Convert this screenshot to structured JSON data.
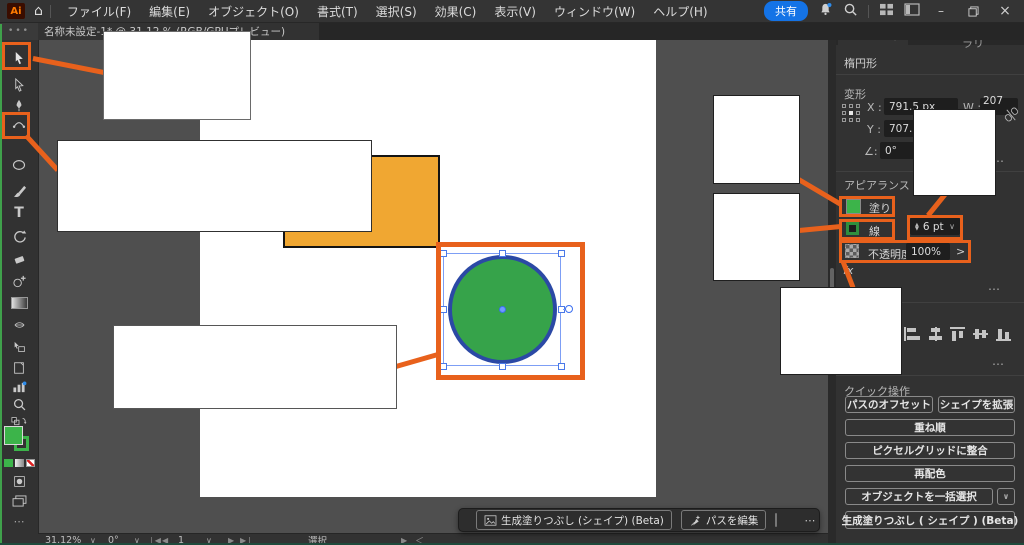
{
  "colors": {
    "annotation_orange": "#E8611C",
    "fill_green": "#3CB44A",
    "shape_orange": "#F0A732",
    "circle_stroke_blue": "#2B49A5",
    "share_blue": "#1473E6",
    "panel_bg": "#323232"
  },
  "icons": {
    "more": "⋯",
    "chevron_down": "∨",
    "chevron_right": ">",
    "home": "⌂",
    "type_tool": "T",
    "double_chevron": "≡",
    "minimize": "–",
    "close": "×",
    "prev": "◀",
    "next": "▶",
    "left_angle": "＜",
    "up": "▲",
    "down": "▼"
  },
  "title_bar": {
    "logo": "Ai",
    "menus": [
      "ファイル(F)",
      "編集(E)",
      "オブジェクト(O)",
      "書式(T)",
      "選択(S)",
      "効果(C)",
      "表示(V)",
      "ウィンドウ(W)",
      "ヘルプ(H)"
    ],
    "share_label": "共有"
  },
  "document_tab": {
    "title": "名称未設定-1* @ 31.12 % (RGB/GPUプレビュー)"
  },
  "canvas": {
    "artboard_color": "#FFFFFF",
    "shapes": [
      {
        "type": "rectangle",
        "fill": "#F0A732",
        "stroke": "#111111"
      },
      {
        "type": "ellipse",
        "fill": "#36A34A",
        "stroke": "#2B49A5",
        "selected": true
      }
    ]
  },
  "panel": {
    "tabs": [
      "プロパティ",
      "レイヤー",
      "CC ライブラリ"
    ],
    "object_type": "楕円形",
    "transform": {
      "label": "変形",
      "x_label": "X :",
      "x_value": "791.5 px",
      "y_label": "Y :",
      "y_value": "707.5",
      "w_label": "W :",
      "w_value": "207 px",
      "angle_label": "∠:",
      "angle_value": "0°"
    },
    "appearance": {
      "label": "アピアランス",
      "fill_label": "塗り",
      "stroke_label": "線",
      "stroke_width": "6 pt",
      "opacity_label": "不透明度",
      "opacity_value": "100%",
      "fx_label": "fx"
    },
    "quick_actions": {
      "label": "クイック操作",
      "offset_path": "パスのオフセット",
      "expand_shape": "シェイプを拡張",
      "arrange": "重ね順",
      "pixel_grid": "ピクセルグリッドに整合",
      "recolor": "再配色",
      "select_objects": "オブジェクトを一括選択",
      "generative_fill": "生成塗りつぶし ( シェイプ ) (Beta)"
    }
  },
  "context_bar": {
    "generative_fill": "生成塗りつぶし (シェイプ) (Beta)",
    "edit_path": "パスを編集"
  },
  "status_bar": {
    "zoom": "31.12%",
    "rotation": "0°",
    "artboard_number": "1",
    "status": "選択"
  }
}
